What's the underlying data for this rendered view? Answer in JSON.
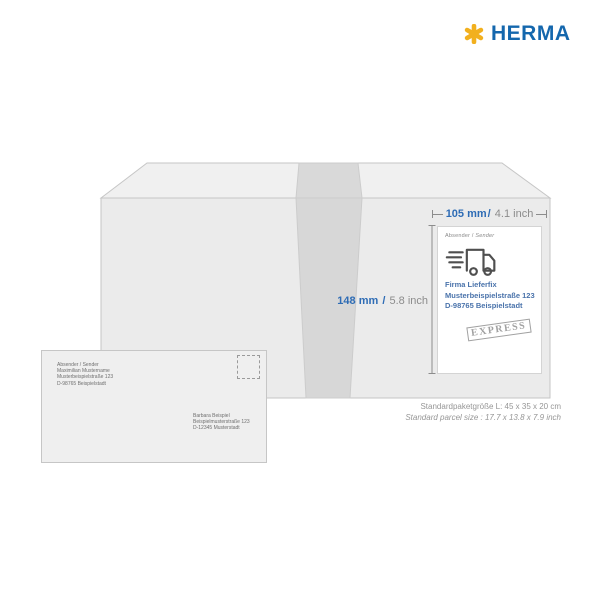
{
  "brand": {
    "name": "HERMA",
    "asterisk_icon": "herma-asterisk-logo-icon"
  },
  "dimensions": {
    "width": {
      "metric": "105 mm",
      "separator": "/",
      "imperial": "4.1 inch"
    },
    "height": {
      "metric": "148 mm",
      "separator": "/",
      "imperial": "5.8 inch"
    }
  },
  "shipping_label": {
    "header_de": "Absender",
    "header_sep": "/",
    "header_en": "Sender",
    "truck_icon": "delivery-truck-icon",
    "address_lines": [
      "Firma Lieferfix",
      "Musterbeispielstraße 123",
      "D-98765 Beispielstadt"
    ],
    "stamp_text": "EXPRESS"
  },
  "envelope": {
    "stamp_icon": "postage-stamp-icon",
    "sender_lines": [
      "Absender / Sender",
      "Maximilian Mustername",
      "Musterbeispielstraße 123",
      "D-98765 Beispielstadt"
    ],
    "recipient_lines": [
      "Barbara Beispiel",
      "Beispielmusterstraße 123",
      "D-12345 Musterstadt"
    ]
  },
  "footer": {
    "size_de": "Standardpaketgröße L: 45 x 35 x 20 cm",
    "size_en": "Standard parcel size : 17.7 x 13.8 x 7.9 inch"
  },
  "colors": {
    "brand_blue": "#1467ad",
    "brand_gold": "#f2b01e",
    "dim_blue": "#2e6cb5",
    "dim_gray": "#8c8c8c",
    "dim_gray_text": "#8c8c8c",
    "address_blue": "#4a73ab",
    "muted_gray": "#8a8a8a",
    "stamp_gray": "#919191",
    "env_text": "#6f6f6f",
    "footer_gray": "#969696",
    "truck_gray": "#4f4f4f",
    "box_top": "#f0f0f0",
    "box_front": "#ebebeb",
    "tape": "#d7d7d7",
    "box_stroke": "#c6c6c6"
  }
}
